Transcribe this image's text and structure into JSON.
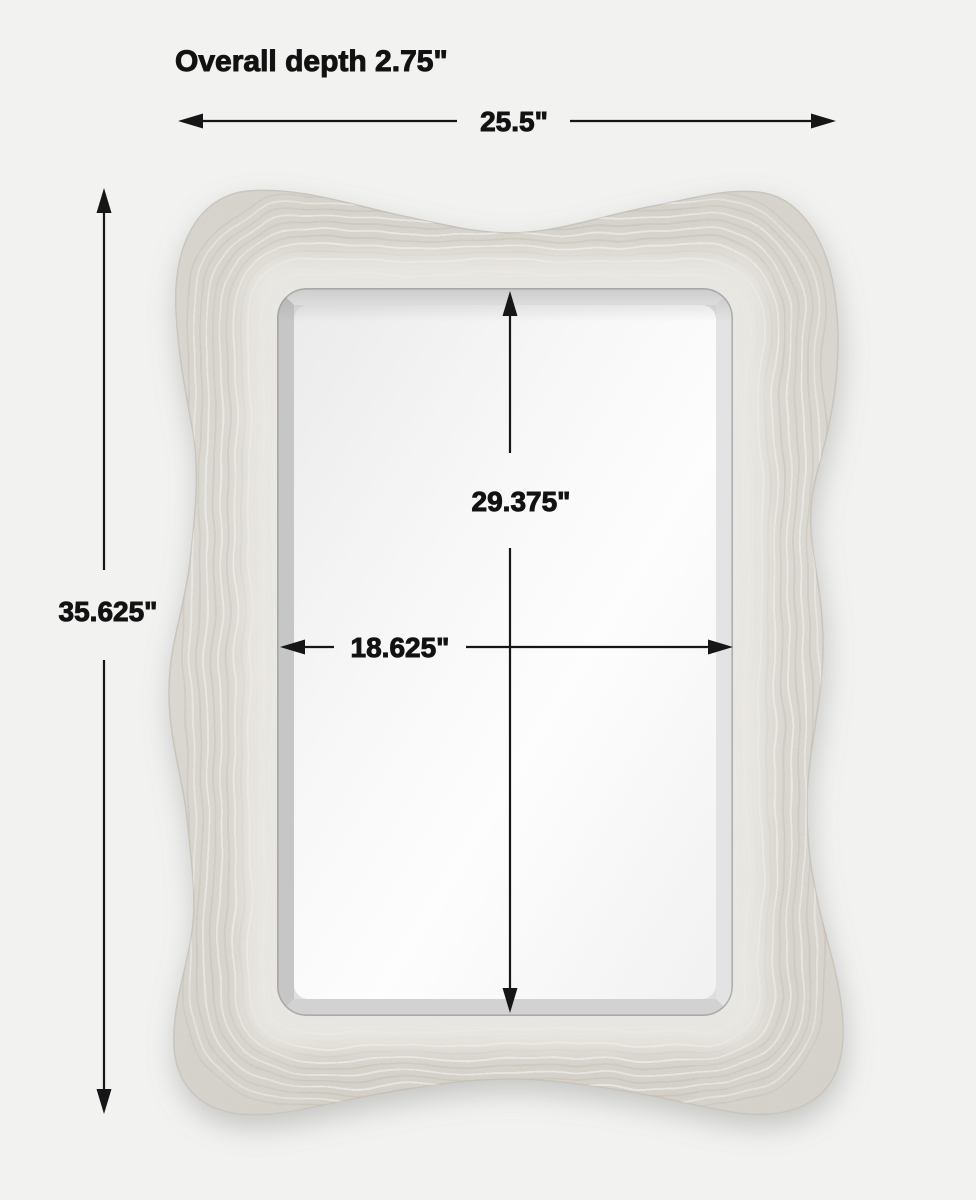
{
  "diagram": {
    "unit": "inches",
    "overall": {
      "depth_label": "Overall depth 2.75\"",
      "width_label": "25.5\"",
      "height_label": "35.625\"",
      "depth_in": 2.75,
      "width_in": 25.5,
      "height_in": 35.625
    },
    "mirror": {
      "width_label": "18.625\"",
      "height_label": "29.375\"",
      "width_in": 18.625,
      "height_in": 29.375
    }
  },
  "colors": {
    "background": "#f2f2f1",
    "frame": "#d9d6cf",
    "frame_texture": "#c2beb5",
    "mirror_face": "#fafafa",
    "bevel": "#d6d6d6",
    "dimension_line": "#161616",
    "text": "#111111"
  }
}
